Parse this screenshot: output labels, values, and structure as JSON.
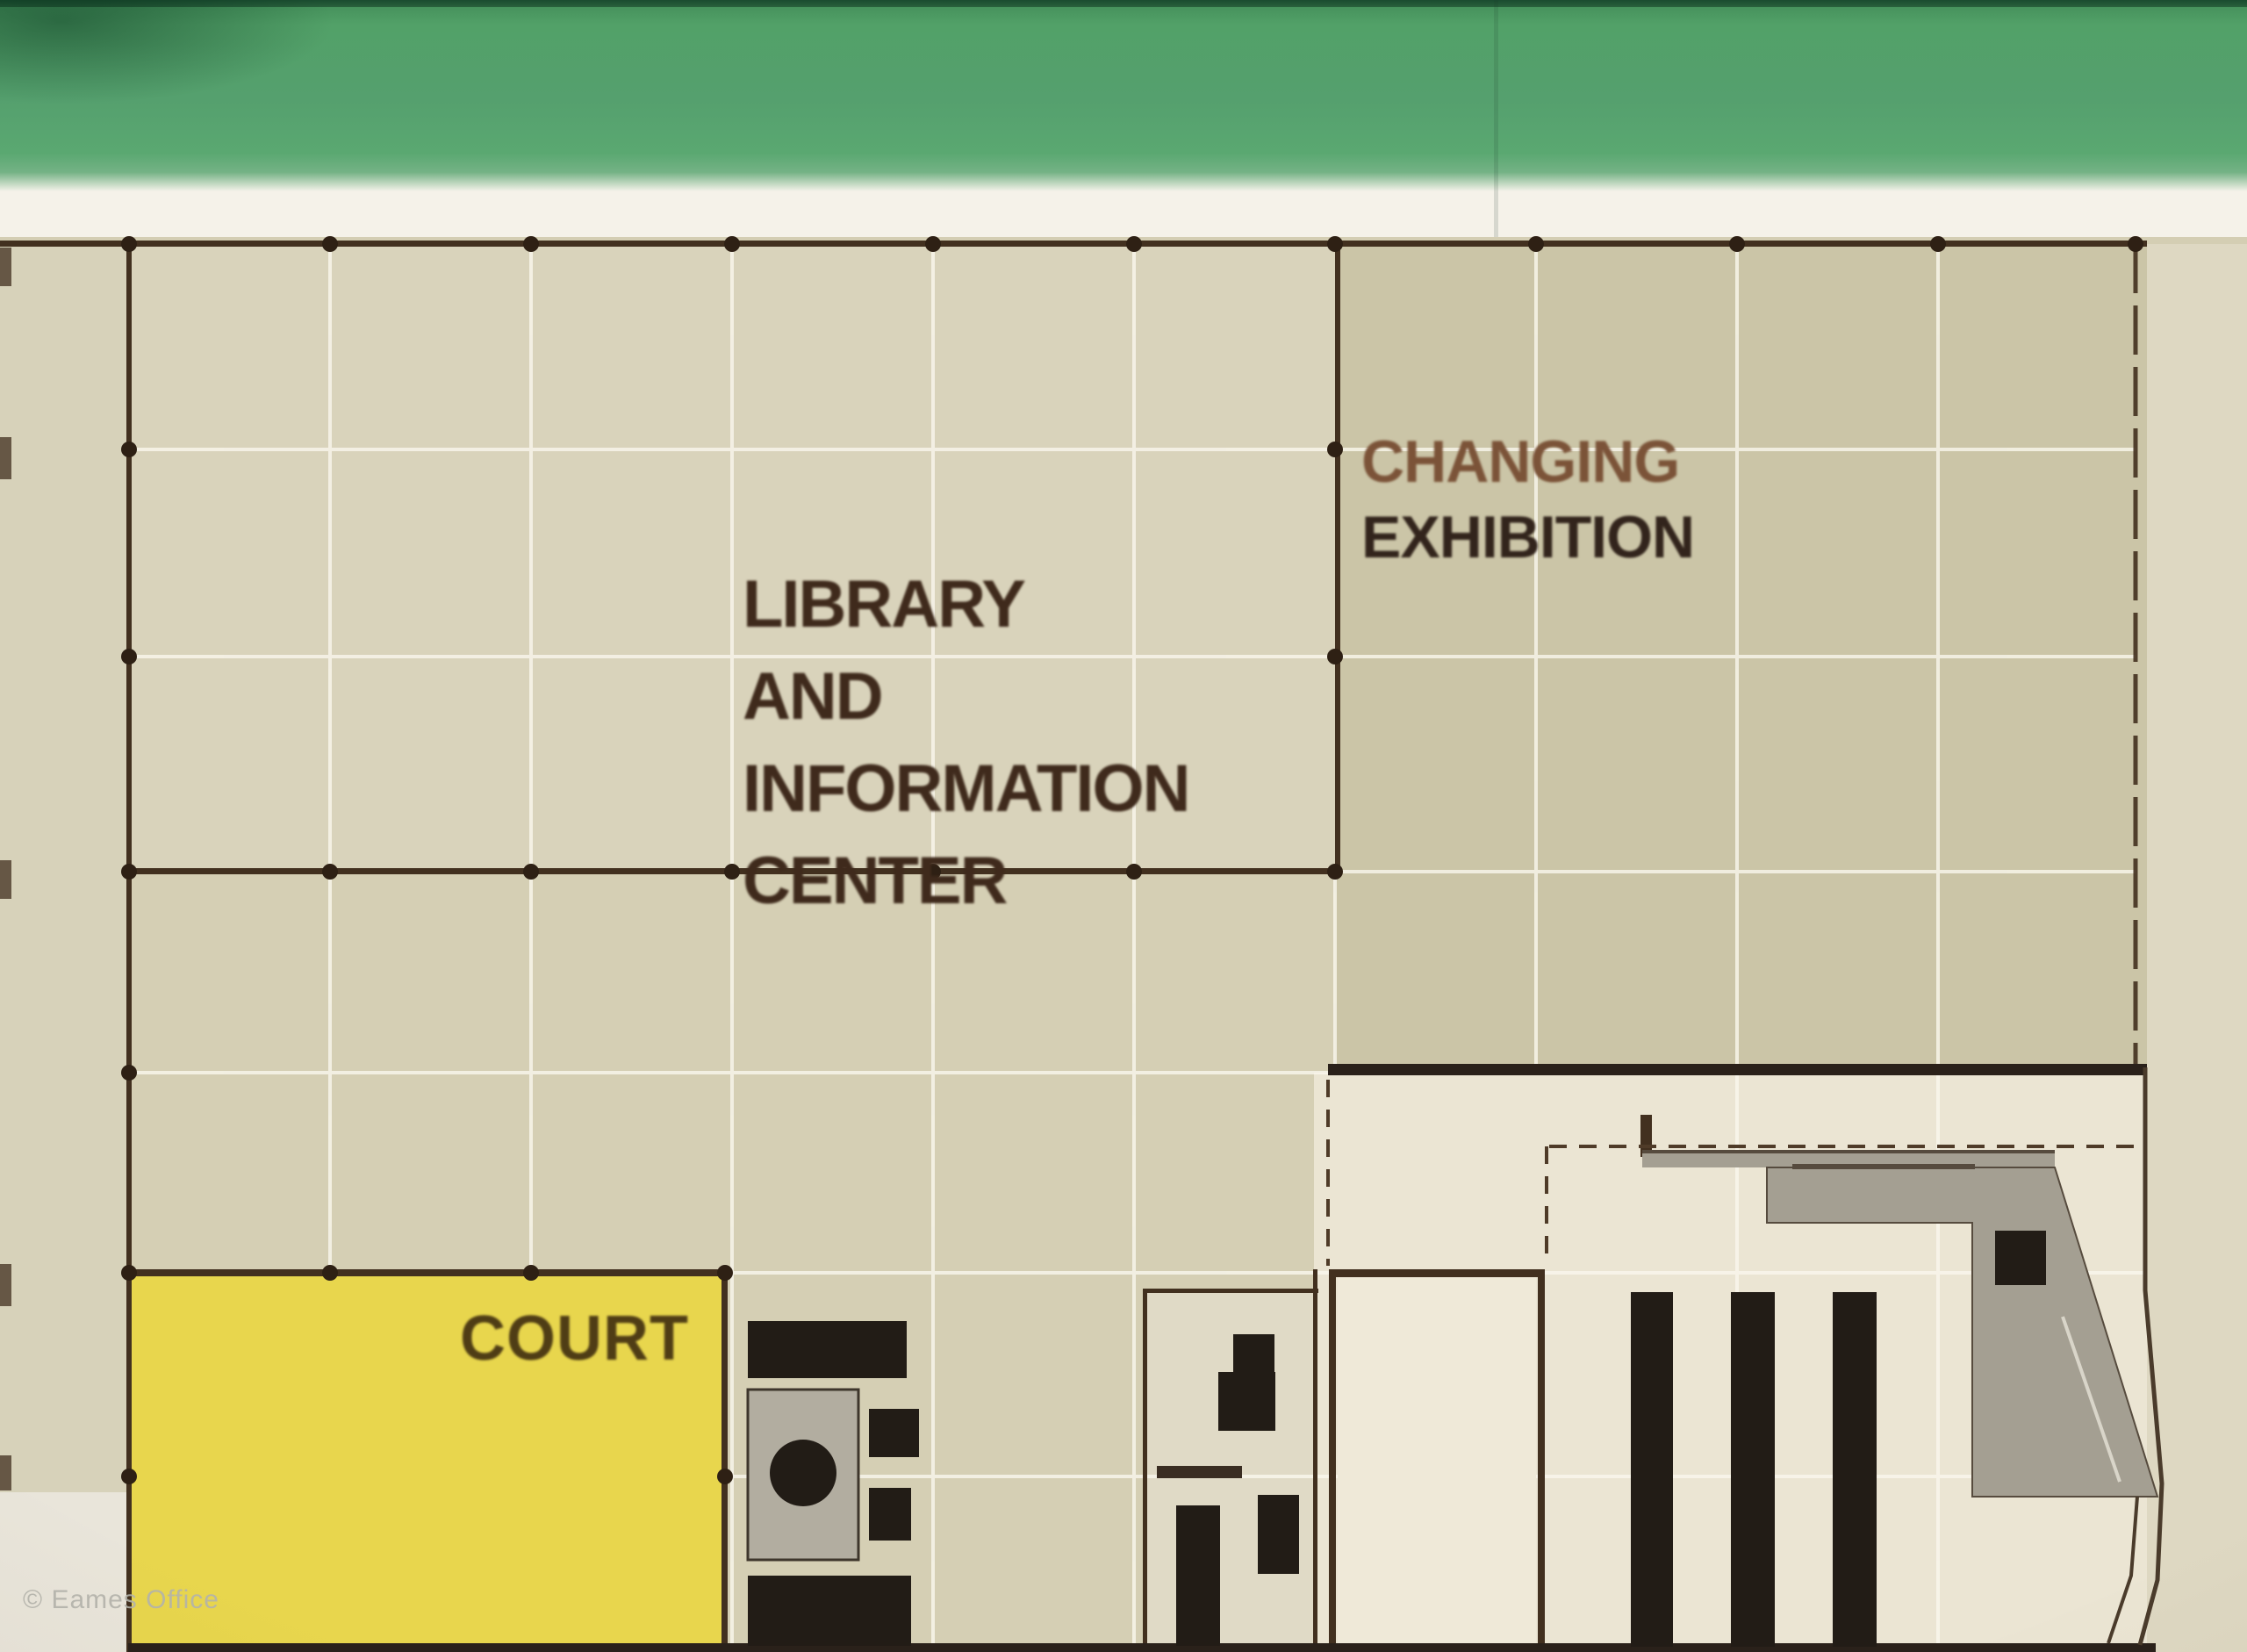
{
  "regions": {
    "library": {
      "lines": [
        "LIBRARY",
        "AND",
        "INFORMATION",
        "CENTER"
      ]
    },
    "changing_exhibition": {
      "lines": [
        "CHANGING",
        "EXHIBITION"
      ]
    },
    "court": {
      "label": "COURT"
    }
  },
  "watermark": "© Eames Office",
  "colors": {
    "green_band": "#55a06e",
    "green_band_dark": "#2b6a45",
    "strip": "#f5f2e9",
    "beige": "#d4ceb3",
    "beige_library": "#d9d3bb",
    "beige_exhibition": "#cbc5a7",
    "beige_lower": "#d5cfb4",
    "room_cream": "#ebe5d3",
    "small_room_cream": "#efe9d8",
    "mid_room_cream": "#e0dac6",
    "margin_left": "#d7d2ba",
    "margin_right": "#ded8c2",
    "court_yellow": "#e8d64d",
    "wall": "#42301f",
    "wall_dark": "#2a211a",
    "dot": "#2e2014",
    "grid_line": "#faf7ee",
    "dash": "#4f3b28",
    "ink": "#221c16",
    "stage_gray": "#a49f92",
    "stage_gray_light": "#b9b4a7",
    "furniture_gray": "#b2ada0",
    "text_library": "#3f2a1c",
    "text_changing": "#7b5338",
    "text_exhibition": "#32241c",
    "text_court": "#4f3d15",
    "watermark_gray": "#b4b4ac"
  }
}
